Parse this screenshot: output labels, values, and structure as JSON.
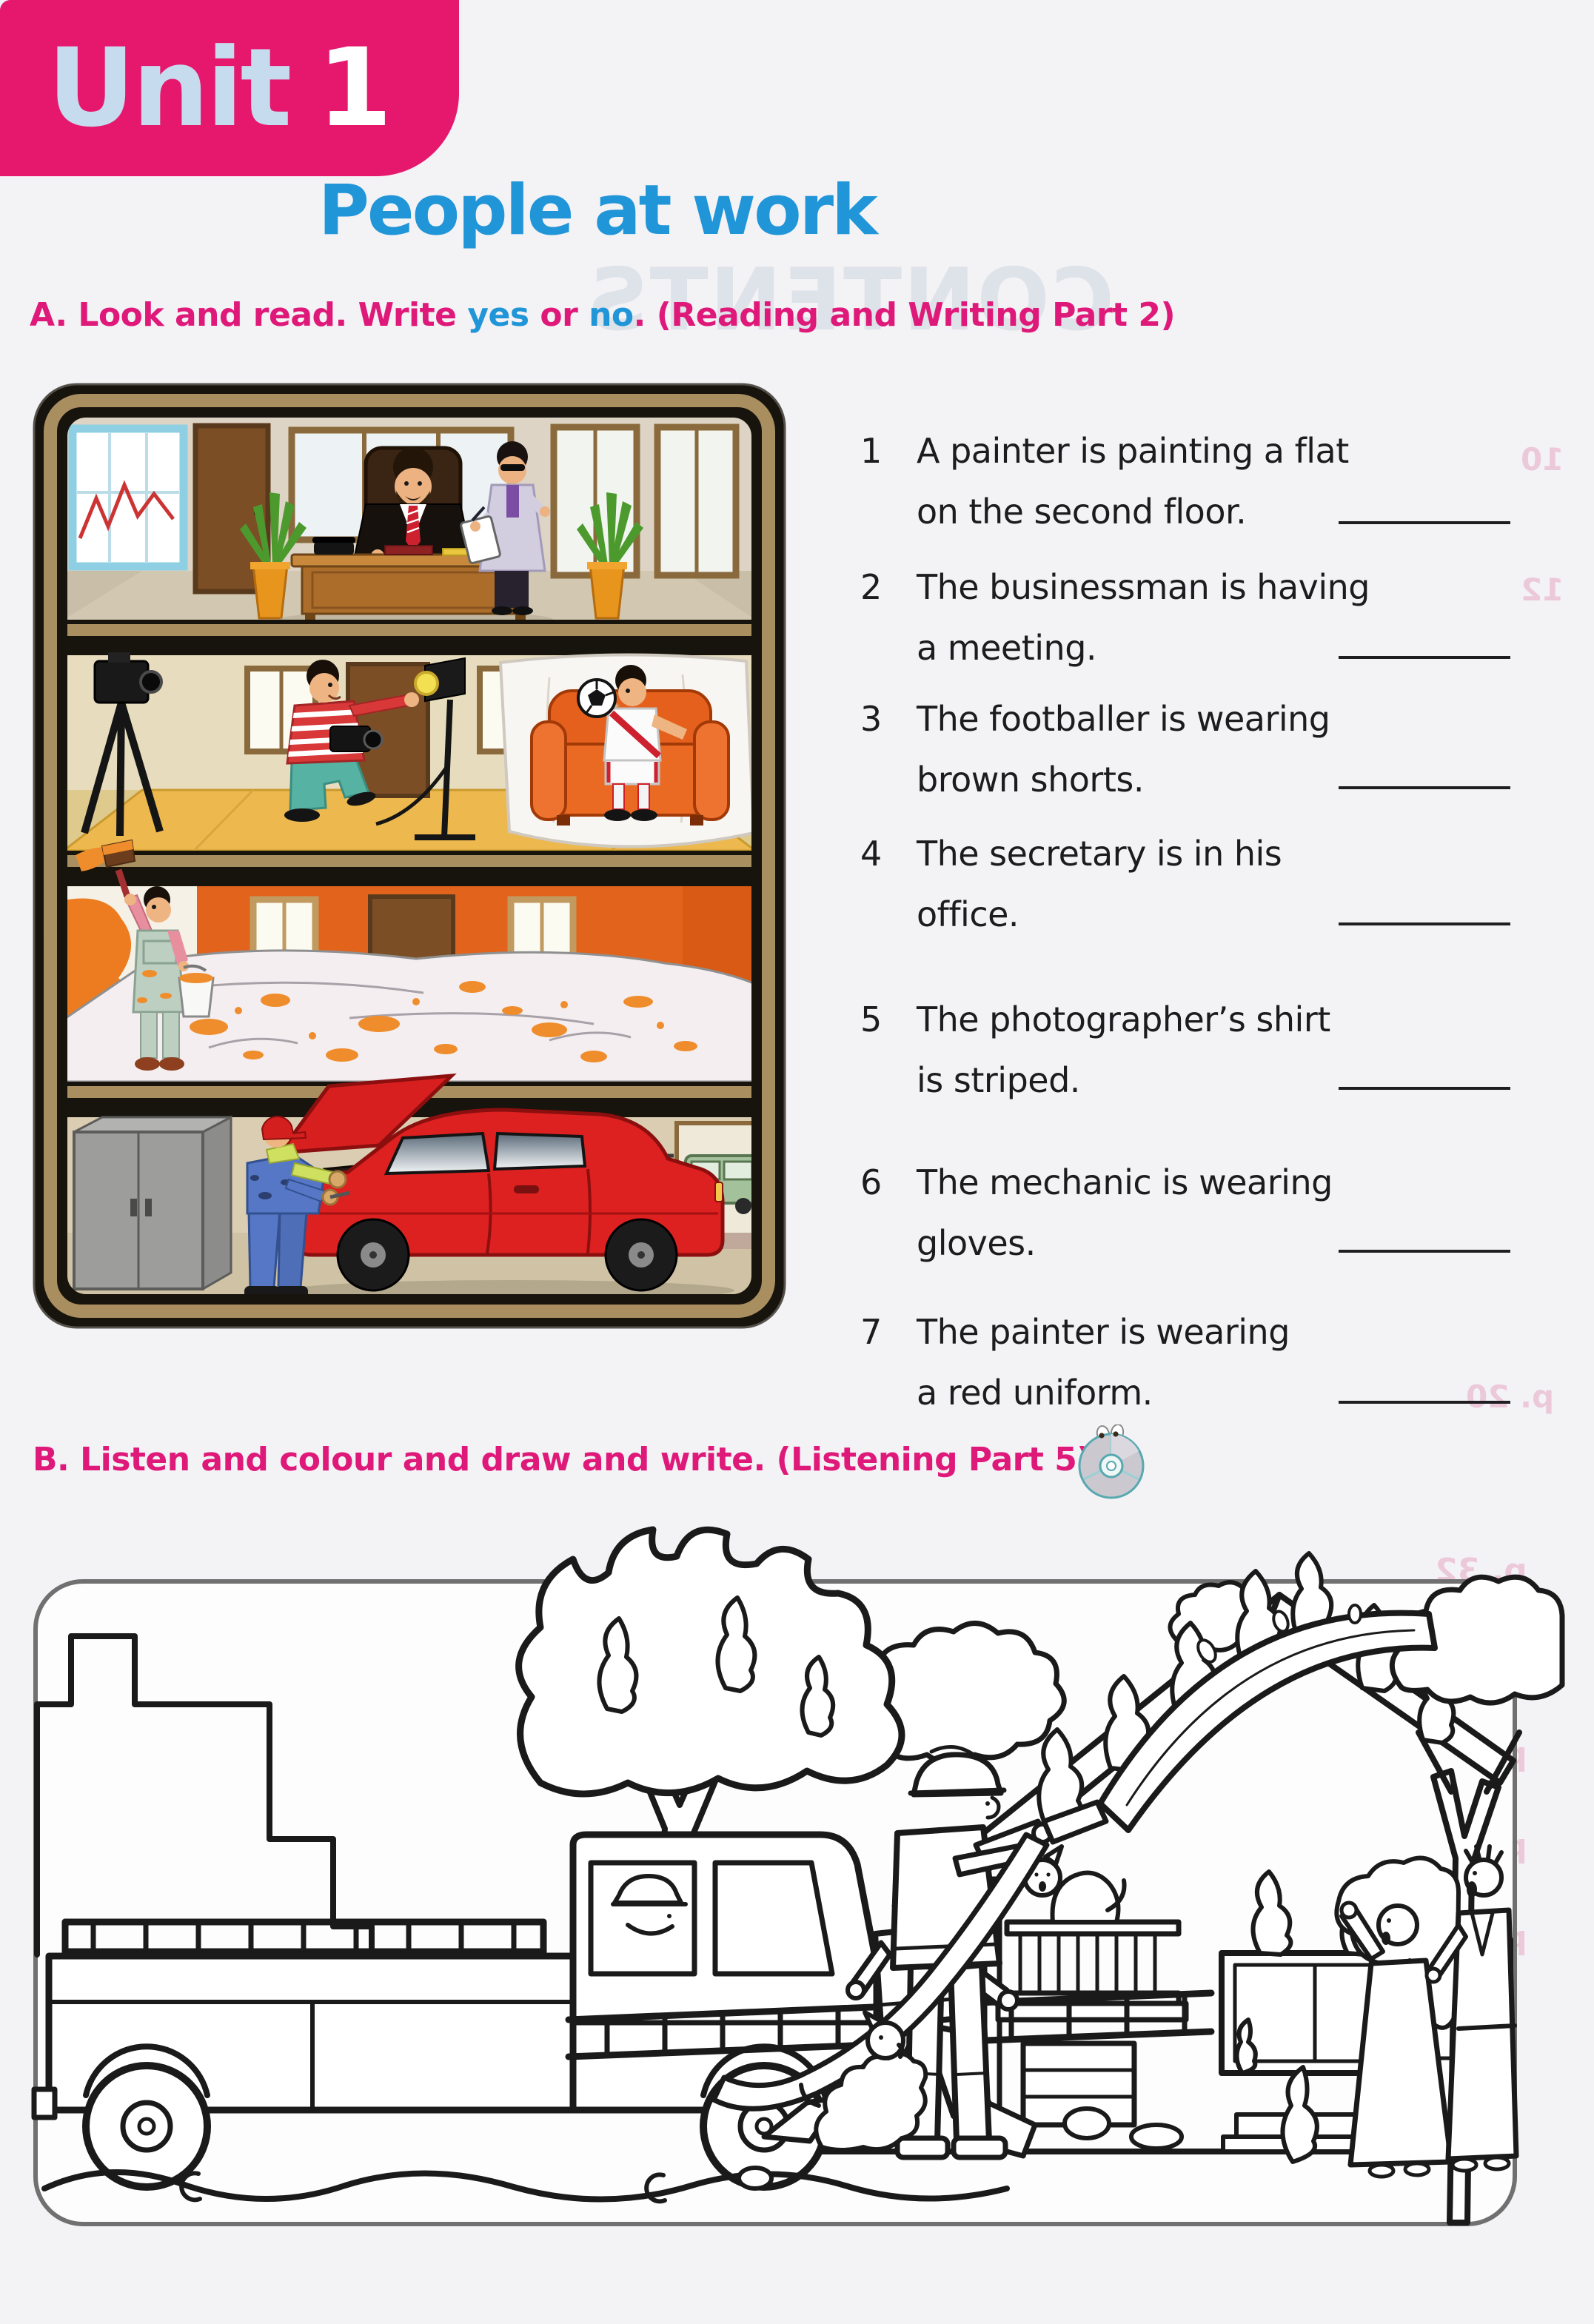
{
  "unit_badge": {
    "label": "Unit",
    "number": "1"
  },
  "title": "People at work",
  "section_a": {
    "heading": {
      "part1": "A. Look and read. Write ",
      "yes": "yes",
      "part2": " or ",
      "no": "no",
      "part3": ". (Reading and Writing Part 2)"
    },
    "questions": [
      {
        "num": "1",
        "line1": "A painter is painting a flat",
        "line2": "on the second floor."
      },
      {
        "num": "2",
        "line1": "The businessman is having",
        "line2": "a meeting."
      },
      {
        "num": "3",
        "line1": "The footballer is wearing",
        "line2": "brown shorts."
      },
      {
        "num": "4",
        "line1": "The secretary is in his",
        "line2": "office."
      },
      {
        "num": "5",
        "line1": "The photographer’s shirt",
        "line2": "is striped."
      },
      {
        "num": "6",
        "line1": "The mechanic is wearing",
        "line2": "gloves."
      },
      {
        "num": "7",
        "line1": "The painter is wearing",
        "line2": "a red uniform."
      }
    ],
    "illustration_scenes": [
      "businessman and secretary in office",
      "photographer taking photo of footballer",
      "painter painting flat orange",
      "mechanic fixing red car in garage"
    ]
  },
  "section_b": {
    "heading": "B. Listen and colour and draw and write. (Listening Part 5)",
    "icon": "cd-icon",
    "scene": "fire scene colouring picture: fire engine, burning house and tree, firefighters, cat, dog, two people"
  },
  "ghost_text": {
    "contents": "CONTENTS",
    "list_pages": [
      "10",
      "12",
      "p. 20"
    ],
    "panel_pages": [
      "p. 32",
      "p. 45",
      "p. 58",
      "p. 76",
      "p. 84"
    ]
  },
  "colors": {
    "banner_pink": "#e5186e",
    "unit_label_blue": "#c6dbee",
    "title_blue": "#2095d8",
    "heading_pink": "#df1979",
    "car_red": "#dd2020",
    "wall_orange": "#e2631c",
    "armchair_orange": "#e4601c",
    "frame_khaki": "#a98e60"
  }
}
